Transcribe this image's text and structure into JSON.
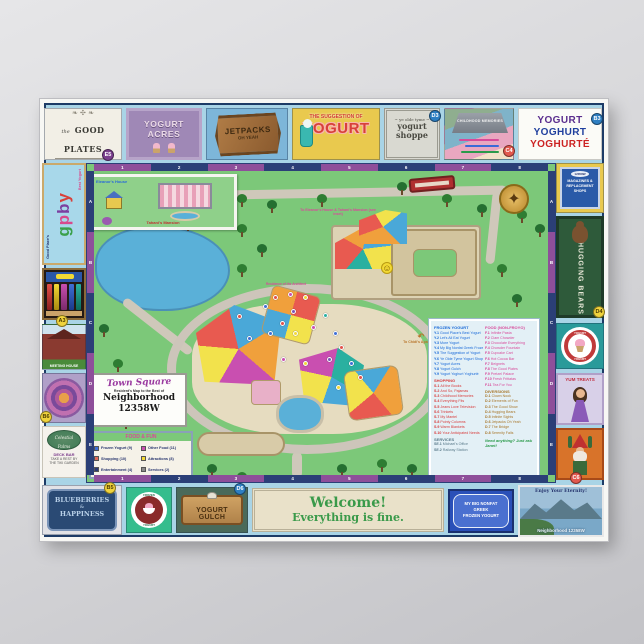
{
  "signs": {
    "good_plates": {
      "pre": "the",
      "label": "GOOD PLATES",
      "flourish": "❧ ✣ ❧",
      "badge": "E5"
    },
    "yogurt_acres": {
      "label": "YOGURT ACRES"
    },
    "jetpacks": {
      "label": "JETPACKS",
      "sub": "OH YEAH"
    },
    "suggestion": {
      "pre": "THE SUGGESTION OF",
      "label": "YOGURT"
    },
    "shoppe": {
      "pre": "~ ye olde tyme ~",
      "line1": "yogurt",
      "line2": "shoppe",
      "badge": "D3"
    },
    "childhood": {
      "label": "CHILDHOOD MEMORIES",
      "badge": "C4"
    },
    "yoghurte": {
      "line1": "YOGURT",
      "line2": "YOGHURT",
      "line3": "YOGHURTÉ",
      "badge": "B3"
    }
  },
  "left": {
    "gpby": {
      "side_left": "Good Place's",
      "l1": "g",
      "l2": "p",
      "l3": "b",
      "l4": "y",
      "side_right": "Best Yogurt",
      "badge": "A3"
    },
    "house_caption": "MEETING HOUSE",
    "mandala_badge": "B6",
    "celestial": {
      "logo": "Celestial Palms",
      "line1": "DECK BAR",
      "line2": "TAKE A REST BY",
      "line3": "THE TIKI GARDEN"
    }
  },
  "right": {
    "shops_sign": {
      "top": "12358W",
      "line1": "MAGAZINES &",
      "line2": "REPLACEMENT",
      "line3": "SHOPS"
    },
    "hugging": {
      "label": "HUGGING BEARS",
      "badge": "D4"
    },
    "ring": {
      "top": "YOGURT",
      "bottom": "YOGURT"
    },
    "yum": {
      "label": "YUM TREATS"
    },
    "gnome_badge": "C6",
    "postcard": {
      "top": "Enjoy Your Eternity!",
      "bottom": "Neighborhood 12358W"
    }
  },
  "bottom": {
    "blueberry": {
      "line1": "BLUEBERRIES",
      "line2": "&",
      "line3": "HAPPINESS",
      "badge": "B5"
    },
    "medal": {
      "top": "FROZEN",
      "bottom": "YOGURT"
    },
    "gulch": {
      "label": "YOGURT GULCH",
      "badge": "D6"
    },
    "welcome": {
      "line1": "Welcome!",
      "line2": "Everything is fine."
    },
    "nonfat": {
      "line1": "MY BIG NONFAT",
      "line2": "GREEK",
      "line3": "FROZEN YOGURT"
    }
  },
  "map": {
    "grid_cols": [
      "1",
      "2",
      "3",
      "4",
      "5",
      "6",
      "7",
      "8"
    ],
    "grid_rows": [
      "A",
      "B",
      "C",
      "D",
      "E"
    ],
    "inset": {
      "label1": "Eleanor's House",
      "label2": "Tahani's Mansion"
    },
    "labels": {
      "to_inset": "To Eleanor's House & Tahani's Mansion (see inset)",
      "to_chidi": "To Chidi's Apartment",
      "to_chidi_arrow": "↶",
      "residence": "Residence of the Architect",
      "smiley": "☺",
      "compass": "✦"
    },
    "title_box": {
      "arch": "Town Square",
      "sub": "Resident's Map to the Best of",
      "big1": "Neighborhood",
      "big2": "12358W"
    },
    "legend": {
      "title": "FOOD & FUN",
      "items": [
        {
          "color": "#3f6fd6",
          "label": "Frozen Yogurt (9)"
        },
        {
          "color": "#e06a5a",
          "label": "Shopping (10)"
        },
        {
          "color": "#2c3a74",
          "label": "Entertainment (4)"
        },
        {
          "color": "#c94fb0",
          "label": "Other Food (11)"
        },
        {
          "color": "#f2d935",
          "label": "Attractions (8)"
        },
        {
          "color": "#8a8a8a",
          "label": "Services (2)"
        }
      ]
    },
    "directory": {
      "froyo": {
        "title": "FROZEN YOGURT",
        "entries": [
          {
            "code": "Y.1",
            "name": "Good Place's Best Yogurt"
          },
          {
            "code": "Y.2",
            "name": "Let's All Eat Yogurt"
          },
          {
            "code": "Y.3",
            "name": "More Yogurt"
          },
          {
            "code": "Y.4",
            "name": "My Big Nonfat Greek Frozen Yogurt"
          },
          {
            "code": "Y.5",
            "name": "The Suggestion of Yogurt"
          },
          {
            "code": "Y.6",
            "name": "Ye Olde Tyme Yogurt Shoppe"
          },
          {
            "code": "Y.7",
            "name": "Yogurt Acres"
          },
          {
            "code": "Y.8",
            "name": "Yogurt Gulch"
          },
          {
            "code": "Y.9",
            "name": "Yogurt Yoghurt Yoghurté"
          }
        ]
      },
      "food": {
        "title": "FOOD (NON-FROYO)",
        "entries": [
          {
            "code": "F.1",
            "name": "Infinite Pasta"
          },
          {
            "code": "F.2",
            "name": "Clam Chowder"
          },
          {
            "code": "F.3",
            "name": "Chocolate Everything"
          },
          {
            "code": "F.4",
            "name": "Chowder Fountain"
          },
          {
            "code": "F.5",
            "name": "Cupcake Cart"
          },
          {
            "code": "F.6",
            "name": "Hot Cocoa Bar"
          },
          {
            "code": "F.7",
            "name": "Beignets"
          },
          {
            "code": "F.8",
            "name": "The Good Plates"
          },
          {
            "code": "F.9",
            "name": "Pretzel Palace"
          },
          {
            "code": "F.10",
            "name": "Fresh Frittatas"
          },
          {
            "code": "F.11",
            "name": "Tea For You"
          }
        ]
      },
      "shopping": {
        "title": "SHOPPING",
        "entries": [
          {
            "code": "S.1",
            "name": "All the Books"
          },
          {
            "code": "S.2",
            "name": "And So, Pajamas"
          },
          {
            "code": "S.3",
            "name": "Childhood Memories"
          },
          {
            "code": "S.4",
            "name": "Everything Fits"
          },
          {
            "code": "S.5",
            "name": "Jeans Love Television"
          },
          {
            "code": "S.6",
            "name": "Trinkets"
          },
          {
            "code": "S.7",
            "name": "My Mantel"
          },
          {
            "code": "S.8",
            "name": "Pointy Columns"
          },
          {
            "code": "S.9",
            "name": "Warm Blankets"
          },
          {
            "code": "S.10",
            "name": "Your Anticipated Needs"
          }
        ]
      },
      "diversions": {
        "title": "DIVERSIONS",
        "entries": [
          {
            "code": "D.1",
            "name": "Clown Nook"
          },
          {
            "code": "D.2",
            "name": "Elements of Fun"
          },
          {
            "code": "D.3",
            "name": "The Good Show"
          },
          {
            "code": "D.4",
            "name": "Hugging Bears"
          },
          {
            "code": "D.5",
            "name": "Infinite Sights"
          },
          {
            "code": "D.6",
            "name": "Jetpacks Oh Yeah"
          },
          {
            "code": "D.7",
            "name": "The Bridge"
          },
          {
            "code": "D.8",
            "name": "Serenity Falls"
          }
        ]
      },
      "services": {
        "title": "SERVICES",
        "entries": [
          {
            "code": "SE.1",
            "name": "Michael's Office"
          },
          {
            "code": "SE.2",
            "name": "Railway Station"
          }
        ]
      },
      "note": "Need anything? Just ask Janet!"
    },
    "markers": [
      {
        "x": "176px",
        "y": "140px",
        "c": "#3f6fd6"
      },
      {
        "x": "186px",
        "y": "131px",
        "c": "#e25048"
      },
      {
        "x": "201px",
        "y": "128px",
        "c": "#c94fb0"
      },
      {
        "x": "216px",
        "y": "131px",
        "c": "#f2d935"
      },
      {
        "x": "204px",
        "y": "145px",
        "c": "#7b52b8"
      },
      {
        "x": "193px",
        "y": "157px",
        "c": "#e25048"
      },
      {
        "x": "181px",
        "y": "167px",
        "c": "#3f6fd6"
      },
      {
        "x": "206px",
        "y": "167px",
        "c": "#f2d935"
      },
      {
        "x": "224px",
        "y": "161px",
        "c": "#c94fb0"
      },
      {
        "x": "236px",
        "y": "149px",
        "c": "#2ab0a0"
      },
      {
        "x": "246px",
        "y": "167px",
        "c": "#3f6fd6"
      },
      {
        "x": "252px",
        "y": "181px",
        "c": "#e25048"
      },
      {
        "x": "240px",
        "y": "193px",
        "c": "#7b52b8"
      },
      {
        "x": "216px",
        "y": "197px",
        "c": "#f2d935"
      },
      {
        "x": "194px",
        "y": "193px",
        "c": "#c94fb0"
      },
      {
        "x": "262px",
        "y": "197px",
        "c": "#3f6fd6"
      },
      {
        "x": "271px",
        "y": "211px",
        "c": "#e25048"
      },
      {
        "x": "249px",
        "y": "221px",
        "c": "#f2d935"
      },
      {
        "x": "150px",
        "y": "150px",
        "c": "#e25048"
      },
      {
        "x": "160px",
        "y": "172px",
        "c": "#3f6fd6"
      }
    ]
  }
}
